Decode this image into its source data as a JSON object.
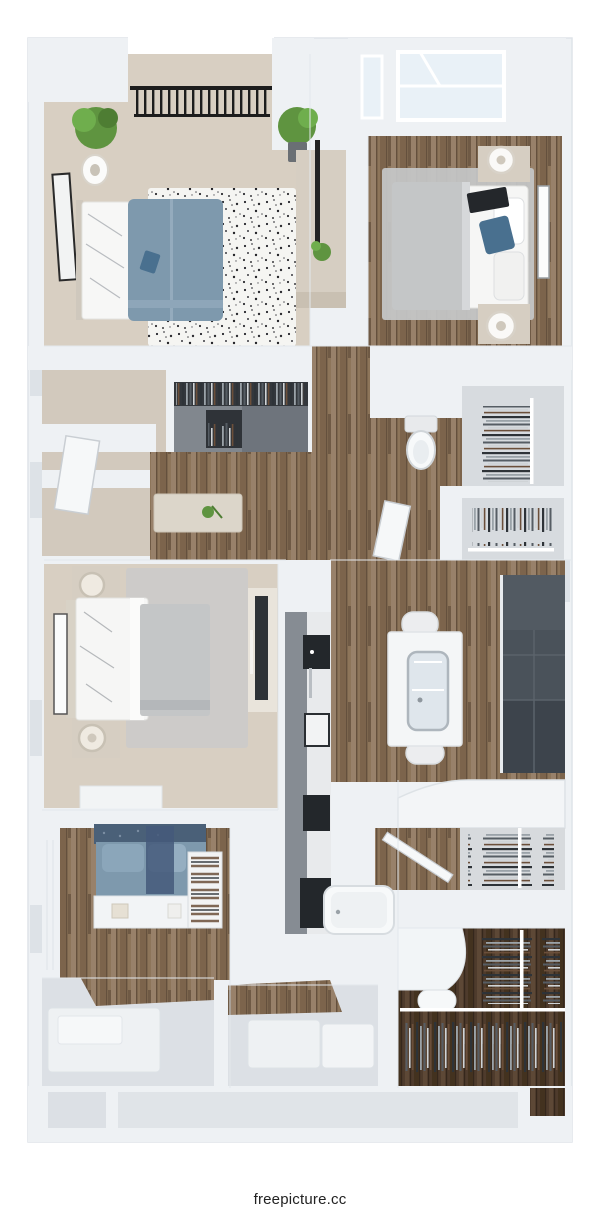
{
  "watermark": {
    "text": "freepicture.cc"
  },
  "palette": {
    "wall": "#eef1f4",
    "wall_shade": "#dde2e7",
    "floor_gray": "#dce0e5",
    "carpet": "#d8cfc2",
    "wood": "#8d755a",
    "wood_dark": "#4e3b2c",
    "rug_gray": "#c6c8c9",
    "rug_speckle_base": "#f5f5f2",
    "duvet_blue": "#7e99ad",
    "pillow_blue": "#49708f",
    "duvet_gray": "#c4c6c7",
    "cabinet_charcoal": "#4a525a",
    "cabinet_gray": "#868c93",
    "counter_black": "#23272b",
    "wardrobe_gray": "#81878e",
    "beige_furniture": "#d6cec2",
    "plant_green": "#5f9440",
    "railing_black": "#1d1d1d",
    "skylight_glass": "#e9f1f7",
    "fixture_white": "#f7f9fa",
    "text_dark": "#222222"
  },
  "scene": {
    "type": "3d-floor-plan-render",
    "view": "top-down",
    "rooms": [
      {
        "id": "bedroom-top-left",
        "contents": [
          "double bed with blue duvet and white sheets",
          "black-and-white speckled rug",
          "balcony opening with black railing",
          "two potted green plants",
          "leaning wall art with black frame",
          "white vase lamp"
        ]
      },
      {
        "id": "bedroom-top-right",
        "contents": [
          "two ceiling skylights",
          "bed with gray throw, white sheets and blue accent pillow",
          "black laptop on bed",
          "gray rug",
          "two beige nightstands with round white lamps",
          "framed art on right wall",
          "light wood plank floor"
        ]
      },
      {
        "id": "hallway-middle",
        "contents": [
          "gray wardrobe with hanging clothes",
          "beige console table with small plant",
          "tall beige cabinet with black pole shelf and plants",
          "wood plank floor",
          "open white doors"
        ]
      },
      {
        "id": "bathroom-middle",
        "contents": [
          "white toilet against wall",
          "wood plank floor"
        ]
      },
      {
        "id": "closets-middle-right",
        "contents": [
          "two closets with clothes on rails",
          "white rail dividers"
        ]
      },
      {
        "id": "bedroom-middle-left",
        "contents": [
          "bed with white sheets and gray duvet",
          "two beige nightstands with lamps",
          "light gray rug",
          "dark TV panel on console",
          "leaning wall art",
          "white dresser",
          "beige carpet"
        ]
      },
      {
        "id": "kitchen-dining",
        "contents": [
          "white island table with glass-front top and faucet",
          "two white chairs",
          "charcoal cabinet run on right wall",
          "galley counter strip with black cooktop and sink segments",
          "wood plank floor"
        ]
      },
      {
        "id": "den-bottom-left",
        "contents": [
          "blue daybed with cushions and navy patterned throw",
          "white ledge shelf with small boxes",
          "shelf stacked with folded clothes",
          "white wainscot wall",
          "wood plank floor"
        ]
      },
      {
        "id": "bathroom-bottom",
        "contents": [
          "white bathtub",
          "black counter segment",
          "light gray floor with white mats"
        ]
      },
      {
        "id": "walk-in-closet-bottom-right",
        "contents": [
          "clothes racks full of hanging garments",
          "white rails",
          "curved white counter",
          "dark wood plank floor"
        ]
      },
      {
        "id": "storage-bottom",
        "contents": [
          "empty light gray floor compartments along bottom wall"
        ]
      }
    ]
  }
}
